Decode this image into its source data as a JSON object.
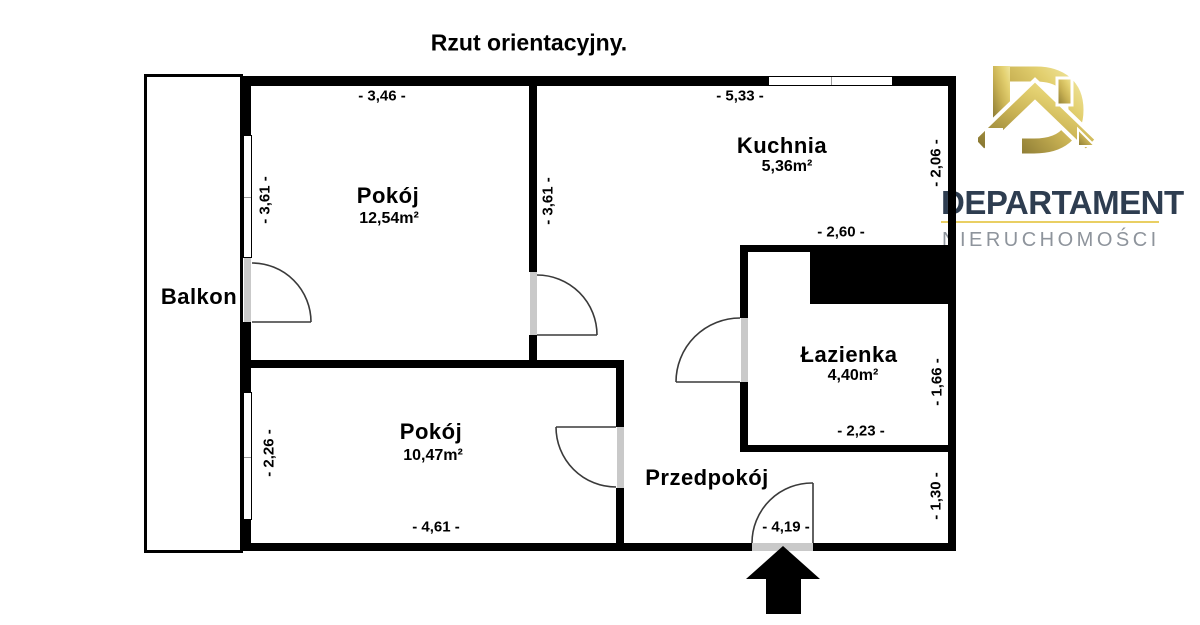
{
  "title": "Rzut orientacyjny.",
  "rooms": {
    "pokoj1": {
      "name": "Pokój",
      "area": "12,54m²"
    },
    "pokoj2": {
      "name": "Pokój",
      "area": "10,47m²"
    },
    "kuchnia": {
      "name": "Kuchnia",
      "area": "5,36m²"
    },
    "lazienka": {
      "name": "Łazienka",
      "area": "4,40m²"
    },
    "przedpokoj": {
      "name": "Przedpokój"
    },
    "balkon": {
      "name": "Balkon"
    }
  },
  "dimensions": {
    "pokoj1_width": "- 3,46 -",
    "kuchnia_width": "- 5,33 -",
    "pokoj1_height": "- 3,61 -",
    "kuchnia_height": "- 3,61 -",
    "right_upper": "- 2,06 -",
    "lazienka_width": "- 2,60 -",
    "right_mid": "- 1,66 -",
    "lazienka_bottom": "- 2,23 -",
    "pokoj2_height": "- 2,26 -",
    "pokoj2_width": "- 4,61 -",
    "entrance_width": "- 4,19 -",
    "right_lower": "- 1,30 -"
  },
  "logo": {
    "brand": "DEPARTAMENT",
    "subtitle": "NIERUCHOMOŚCI"
  },
  "icons": {
    "entrance_arrow": "up-arrow marking entrance",
    "logo_mark": "gold letter D combined with house"
  },
  "colors": {
    "wall": "#000000",
    "door_jamb": "#c9c9c9",
    "logo_navy": "#2e3d50",
    "logo_gold_line": "#e9cf63",
    "logo_gray": "#8e949c",
    "logo_gold_dark": "#8a7933",
    "logo_gold_light": "#efe49c"
  }
}
